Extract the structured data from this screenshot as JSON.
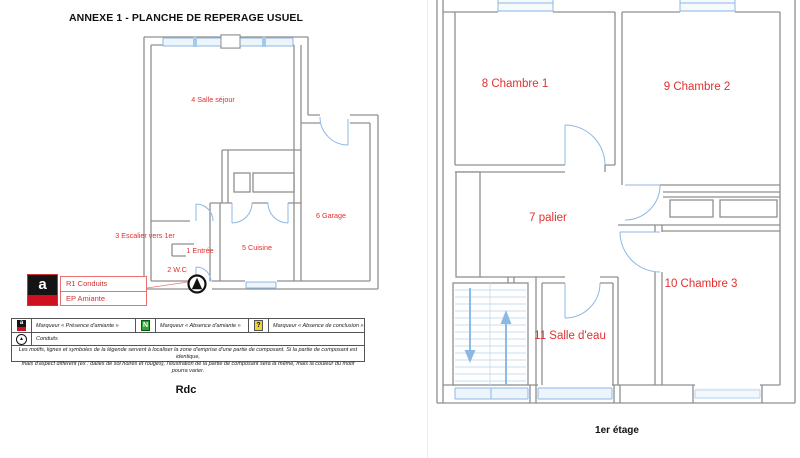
{
  "document": {
    "title": "ANNEXE 1 - PLANCHE DE REPERAGE USUEL"
  },
  "rdc": {
    "caption": "Rdc",
    "rooms": [
      "4 Salle séjour",
      "3 Escalier vers 1er",
      "1 Entrée",
      "2 W.C",
      "5 Cuisine",
      "6 Garage"
    ]
  },
  "etage": {
    "caption": "1er étage",
    "rooms": [
      "8 Chambre 1",
      "9 Chambre 2",
      "7 palier",
      "10 Chambre 3",
      "11 Salle d'eau"
    ]
  },
  "callout": {
    "line1": "R1 Conduits",
    "line2": "EP Amiante",
    "marker_glyph": "a"
  },
  "legend": {
    "presence": {
      "glyph": "a",
      "label": "Marqueur « Présence d'amiante »"
    },
    "absence": {
      "glyph": "N",
      "label": "Marqueur « Absence d'amiante »"
    },
    "conclusion": {
      "glyph": "?",
      "label": "Marqueur « Absence de conclusion »"
    },
    "conduits": {
      "glyph": "▲",
      "label": "Conduits"
    },
    "note_line1": "Les motifs, lignes et symboles de la légende servent à localiser la zone d'emprise d'une partie de composant. Si la partie de composant est identique,",
    "note_line2": "mais d'aspect différent (ex : dalles de sol noires et rouges), l'illustration de la partie de composant sera la même, mais la couleur du motif pourra varier."
  },
  "colors": {
    "wall_gray": "#8f8f8f",
    "plan_blue": "#8cb8e4",
    "label_red": "#e03030",
    "presence_red": "#cf1020",
    "absence_green": "#2fa335",
    "conclusion_yellow": "#f2d232"
  }
}
